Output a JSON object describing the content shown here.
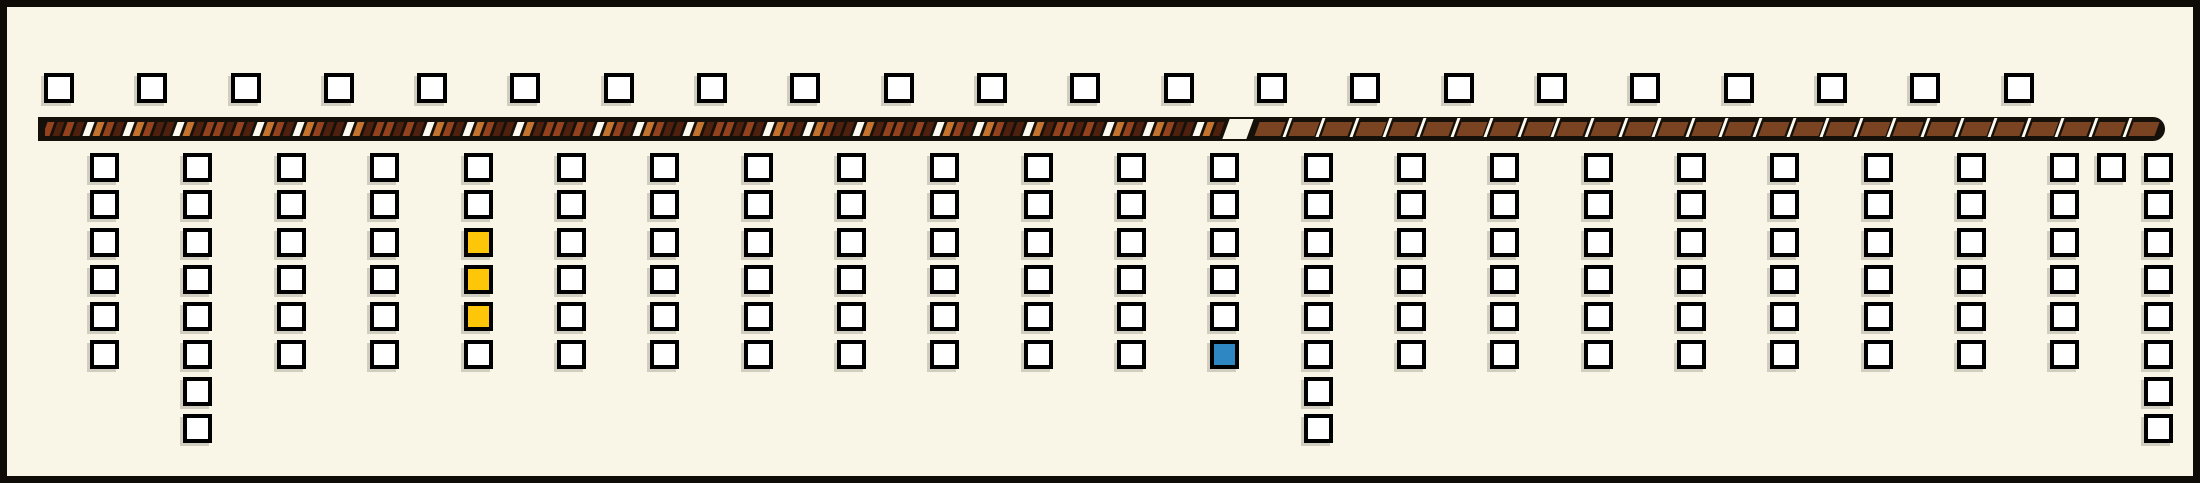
{
  "diagram": {
    "kind": "street-plan-diagram",
    "text_content": "none"
  },
  "colors": {
    "background": "#f9f6e8",
    "frame_border": "#0f0c08",
    "bar_black": "#15100a",
    "square_fill": "#ffffff",
    "square_border": "#000000",
    "yellow_square": "#fdc608",
    "blue_square": "#2e86c3",
    "stripe_tan": "#c4732f",
    "stripe_rust": "#94421e",
    "stripe_dark": "#50200f",
    "stripe_white": "#fdfaf0",
    "brick_brown": "#7a4322"
  },
  "layout": {
    "top_square_y": 66,
    "row_start_y": 146,
    "row_pitch": 37.3,
    "brick_pitch": 33.6,
    "stripe_pitch": 10
  },
  "top_row": {
    "count": 22,
    "x_positions": [
      37,
      130,
      224,
      317,
      410,
      503,
      597,
      690,
      783,
      877,
      970,
      1063,
      1157,
      1250,
      1343,
      1437,
      1530,
      1623,
      1717,
      1810,
      1903,
      1997
    ]
  },
  "bar": {
    "left_pattern": "irregular-diagonal-stripes",
    "right_pattern": "brown-bricks-with-white-separators",
    "stripe_sequence": "rdrdwtrdwtrddwtdrrdrdwtrdwtrddwtdrrdrdwtrdwtrddwtdrrdrdwtrdwtrddwtdrrdrdwtrdwtrddwtdrrdrdwtrdwtrddwtdrrdrdwtrdwtrddwtd",
    "brick_count": 27,
    "has_transition_wedge": true
  },
  "columns": [
    {
      "x": 83,
      "squares": [
        "w",
        "w",
        "w",
        "w",
        "w",
        "w"
      ]
    },
    {
      "x": 176,
      "squares": [
        "w",
        "w",
        "w",
        "w",
        "w",
        "w",
        "w",
        "w"
      ]
    },
    {
      "x": 270,
      "squares": [
        "w",
        "w",
        "w",
        "w",
        "w",
        "w"
      ]
    },
    {
      "x": 363,
      "squares": [
        "w",
        "w",
        "w",
        "w",
        "w",
        "w"
      ]
    },
    {
      "x": 457,
      "squares": [
        "w",
        "w",
        "y",
        "y",
        "y",
        "w"
      ]
    },
    {
      "x": 550,
      "squares": [
        "w",
        "w",
        "w",
        "w",
        "w",
        "w"
      ]
    },
    {
      "x": 643,
      "squares": [
        "w",
        "w",
        "w",
        "w",
        "w",
        "w"
      ]
    },
    {
      "x": 737,
      "squares": [
        "w",
        "w",
        "w",
        "w",
        "w",
        "w"
      ]
    },
    {
      "x": 830,
      "squares": [
        "w",
        "w",
        "w",
        "w",
        "w",
        "w"
      ]
    },
    {
      "x": 923,
      "squares": [
        "w",
        "w",
        "w",
        "w",
        "w",
        "w"
      ]
    },
    {
      "x": 1017,
      "squares": [
        "w",
        "w",
        "w",
        "w",
        "w",
        "w"
      ]
    },
    {
      "x": 1110,
      "squares": [
        "w",
        "w",
        "w",
        "w",
        "w",
        "w"
      ]
    },
    {
      "x": 1203,
      "squares": [
        "w",
        "w",
        "w",
        "w",
        "w",
        "b"
      ]
    },
    {
      "x": 1297,
      "squares": [
        "w",
        "w",
        "w",
        "w",
        "w",
        "w",
        "w",
        "w"
      ]
    },
    {
      "x": 1390,
      "squares": [
        "w",
        "w",
        "w",
        "w",
        "w",
        "w"
      ]
    },
    {
      "x": 1483,
      "squares": [
        "w",
        "w",
        "w",
        "w",
        "w",
        "w"
      ]
    },
    {
      "x": 1577,
      "squares": [
        "w",
        "w",
        "w",
        "w",
        "w",
        "w"
      ]
    },
    {
      "x": 1670,
      "squares": [
        "w",
        "w",
        "w",
        "w",
        "w",
        "w"
      ]
    },
    {
      "x": 1763,
      "squares": [
        "w",
        "w",
        "w",
        "w",
        "w",
        "w"
      ]
    },
    {
      "x": 1857,
      "squares": [
        "w",
        "w",
        "w",
        "w",
        "w",
        "w"
      ]
    },
    {
      "x": 1950,
      "squares": [
        "w",
        "w",
        "w",
        "w",
        "w",
        "w"
      ]
    },
    {
      "x": 2043,
      "squares": [
        "w",
        "w",
        "w",
        "w",
        "w",
        "w"
      ]
    },
    {
      "x": 2090,
      "squares": [
        "w"
      ]
    },
    {
      "x": 2137,
      "squares": [
        "w",
        "w",
        "w",
        "w",
        "w",
        "w",
        "w",
        "w"
      ]
    }
  ]
}
